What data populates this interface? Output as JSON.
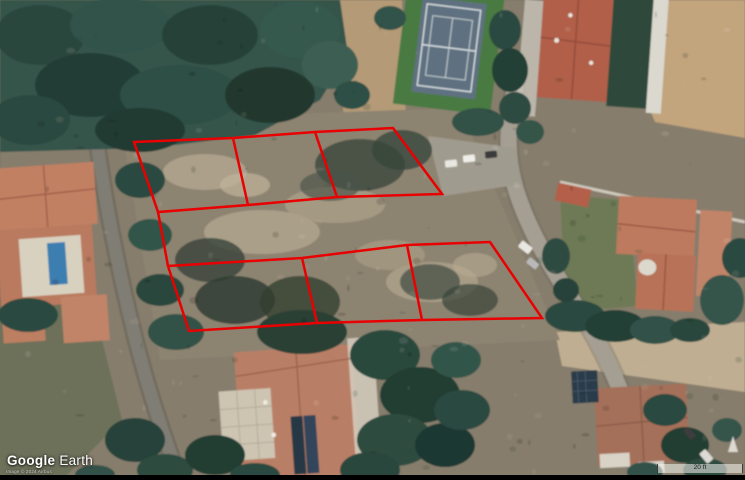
{
  "app": {
    "name": "Google Earth"
  },
  "branding": {
    "logo_google": "Google",
    "logo_earth": "Earth",
    "attribution": "Image © 2024 Airbus"
  },
  "scale_bar": {
    "label": "20 ft"
  },
  "annotation": {
    "stroke_color": "#e90000",
    "stroke_width": 2.5,
    "lot_count": 6,
    "shapes": [
      {
        "id": "top-block-outline",
        "type": "polygon",
        "points": [
          [
            134,
            142
          ],
          [
            233,
            138
          ],
          [
            315,
            132
          ],
          [
            393,
            128
          ],
          [
            442,
            194
          ],
          [
            337,
            197
          ],
          [
            248,
            205
          ],
          [
            158,
            212
          ]
        ]
      },
      {
        "id": "top-block-divider-1",
        "type": "polyline",
        "points": [
          [
            233,
            138
          ],
          [
            248,
            205
          ]
        ]
      },
      {
        "id": "top-block-divider-2",
        "type": "polyline",
        "points": [
          [
            315,
            132
          ],
          [
            337,
            197
          ]
        ]
      },
      {
        "id": "left-boundary-connector",
        "type": "polyline",
        "points": [
          [
            158,
            212
          ],
          [
            168,
            266
          ]
        ]
      },
      {
        "id": "bottom-block-outline",
        "type": "polygon",
        "points": [
          [
            168,
            266
          ],
          [
            302,
            258
          ],
          [
            407,
            245
          ],
          [
            490,
            242
          ],
          [
            542,
            318
          ],
          [
            422,
            320
          ],
          [
            317,
            323
          ],
          [
            189,
            331
          ]
        ]
      },
      {
        "id": "bottom-block-divider-1",
        "type": "polyline",
        "points": [
          [
            302,
            258
          ],
          [
            317,
            323
          ]
        ]
      },
      {
        "id": "bottom-block-divider-2",
        "type": "polyline",
        "points": [
          [
            407,
            245
          ],
          [
            422,
            320
          ]
        ]
      }
    ]
  }
}
